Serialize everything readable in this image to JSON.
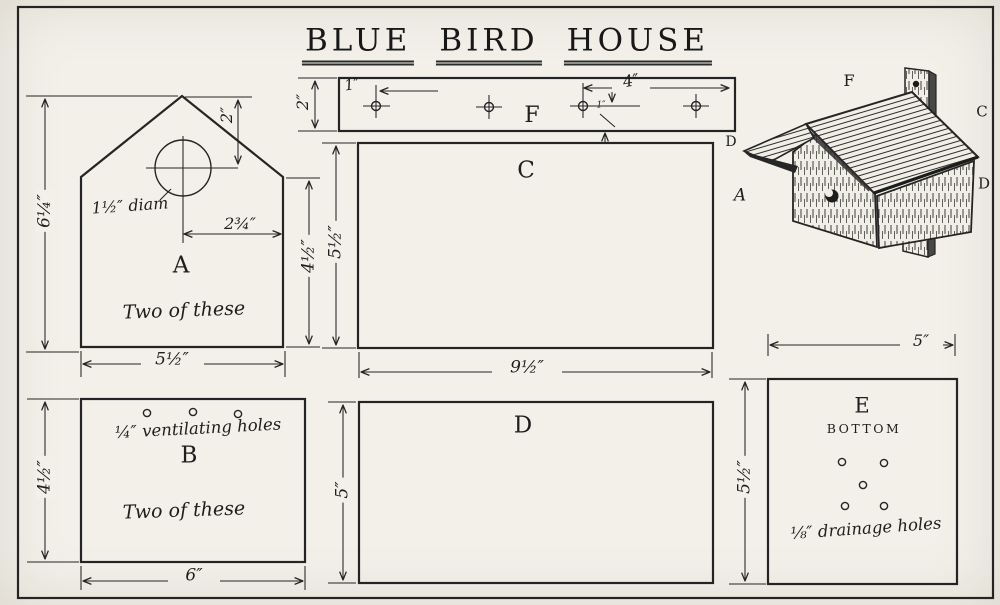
{
  "title": {
    "words": [
      "BLUE",
      "BIRD",
      "HOUSE"
    ]
  },
  "parts": {
    "a": {
      "letter": "A",
      "note": "Two of these",
      "hole_label": "1½″ diam",
      "dim_left": "6¼″",
      "dim_top": "2″",
      "dim_offset": "2¾″",
      "dim_right": "4½″",
      "dim_bottom": "5½″"
    },
    "b": {
      "letter": "B",
      "note": "Two of these",
      "holes_label": "¼″ ventilating holes",
      "dim_left": "4½″",
      "dim_bottom": "6″"
    },
    "c": {
      "letter": "C",
      "dim_left": "5½″",
      "dim_bottom": "9½″"
    },
    "d": {
      "letter": "D",
      "dim_left": "5″"
    },
    "e": {
      "letter": "E",
      "caption": "BOTTOM",
      "holes_label": "⅛″ drainage holes",
      "dim_top": "5″",
      "dim_left": "5½″"
    },
    "f": {
      "letter": "F",
      "dim_width": "2″",
      "dim_first_hole": "1″",
      "dim_end_span": "4″",
      "dim_edge": "1″"
    }
  },
  "assembly": {
    "roof": "F",
    "side": "C",
    "front_edge": "D",
    "front": "A",
    "overhang": "D"
  }
}
